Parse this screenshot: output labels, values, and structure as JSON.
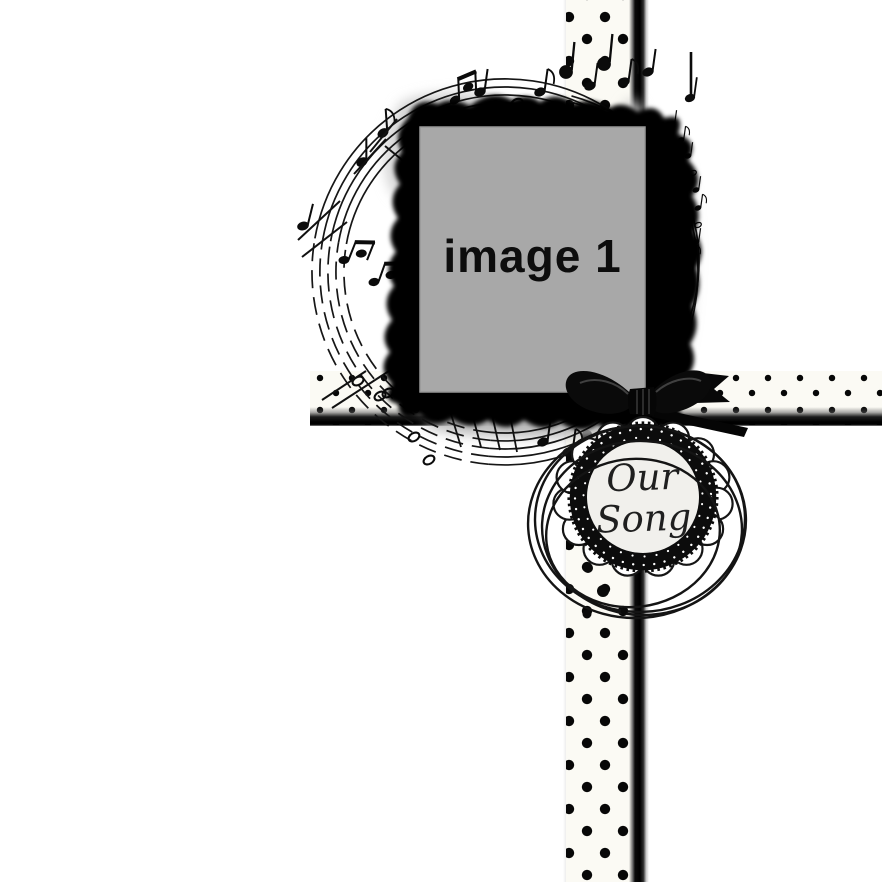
{
  "page": {
    "background_color": "#ffffff"
  },
  "photo_frame": {
    "placeholder_label": "image 1",
    "photo_bg_color": "#a8a8a8",
    "frame_color": "#000000"
  },
  "badge": {
    "line1": "Our",
    "line2": "Song",
    "inner_bg_color": "#f1f0ec",
    "ring_color": "#0c0c0c",
    "scallop_color": "#ffffff"
  },
  "ribbons": {
    "fabric_color": "#fbfaf4",
    "dot_color": "#070707",
    "edge_color": "#000000"
  },
  "decor": {
    "music_staff_color": "#161616",
    "bow_color": "#0a0a0a",
    "swirl_color": "#141414"
  }
}
